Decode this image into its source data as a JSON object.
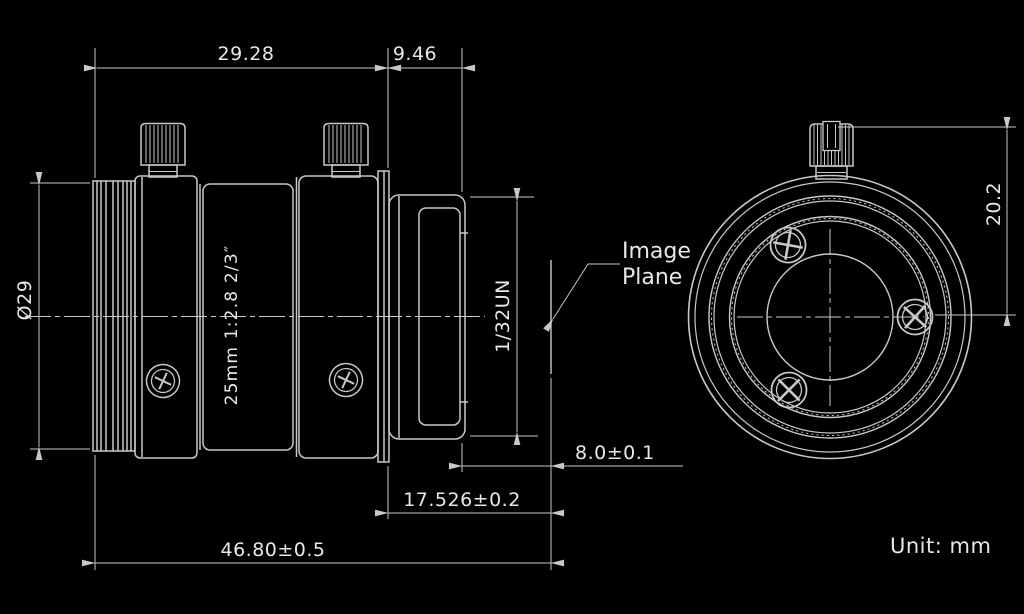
{
  "side_view": {
    "lens_marking": "25mm 1:2.8 2/3″",
    "image_plane": {
      "line1": "Image",
      "line2": "Plane"
    },
    "dimensions": {
      "body_length": "29.28",
      "mount_length": "9.46",
      "front_diameter": "Ø29",
      "mount_thread": "1/32UN",
      "thread_end_to_image_plane": "8.0±0.1",
      "flange_to_image_plane": "17.526±0.2",
      "overall_length": "46.80±0.5"
    }
  },
  "front_view": {
    "dimensions": {
      "top_to_center_height": "20.2"
    }
  },
  "notes": {
    "unit": "Unit: mm"
  },
  "colors": {
    "background": "#000000",
    "line": "#c8c8c8",
    "text": "#e8e8e8"
  }
}
